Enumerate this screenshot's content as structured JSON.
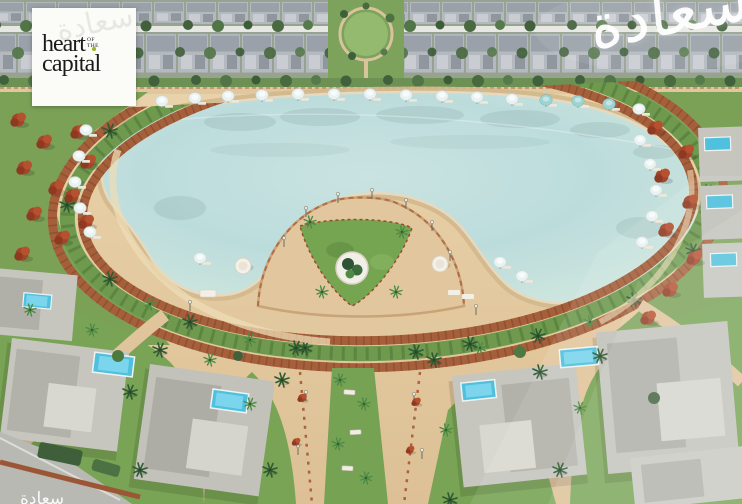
{
  "logo": {
    "word_top": "heart",
    "connector_top": "of",
    "connector_bottom": "the",
    "word_bottom": "capital",
    "accent_dot_color": "#a4b32a",
    "box_background": "#fbfbf8",
    "text_color": "#1b1b1b"
  },
  "watermarks": {
    "arabic_calligraphy": "سعادة",
    "color": "#ffffff",
    "bottom_left_fragment": "سعادة"
  },
  "scene": {
    "description": "Aerial 3D render of a resort community: large crystal lagoon with sandy beach, looped terracotta boardwalk with planted green median, beach umbrellas and loungers, semicircular lawn peninsula with round white planter, rows of townhouses along the top, villas with rooftop pools at the bottom and right edge, palm trees, red flowering trees, landscaped median walkway with benches and a corner road.",
    "palette": {
      "lagoon_water": "#bcdcdc",
      "lagoon_shallow": "#d6e9e2",
      "beach_sand": "#e6cfa8",
      "wet_sand": "#d2b88c",
      "boardwalk_terracotta": "#a55f3a",
      "median_green": "#6f9a4e",
      "grass_green": "#79a455",
      "palm_green": "#2f5a33",
      "red_tree": "#a4452a",
      "villa_roof_gray": "#c6c6bf",
      "pool_cyan": "#4fc0dd",
      "townhouse_roof": "#b3b9bf",
      "road_gray": "#b9b9b4"
    }
  }
}
